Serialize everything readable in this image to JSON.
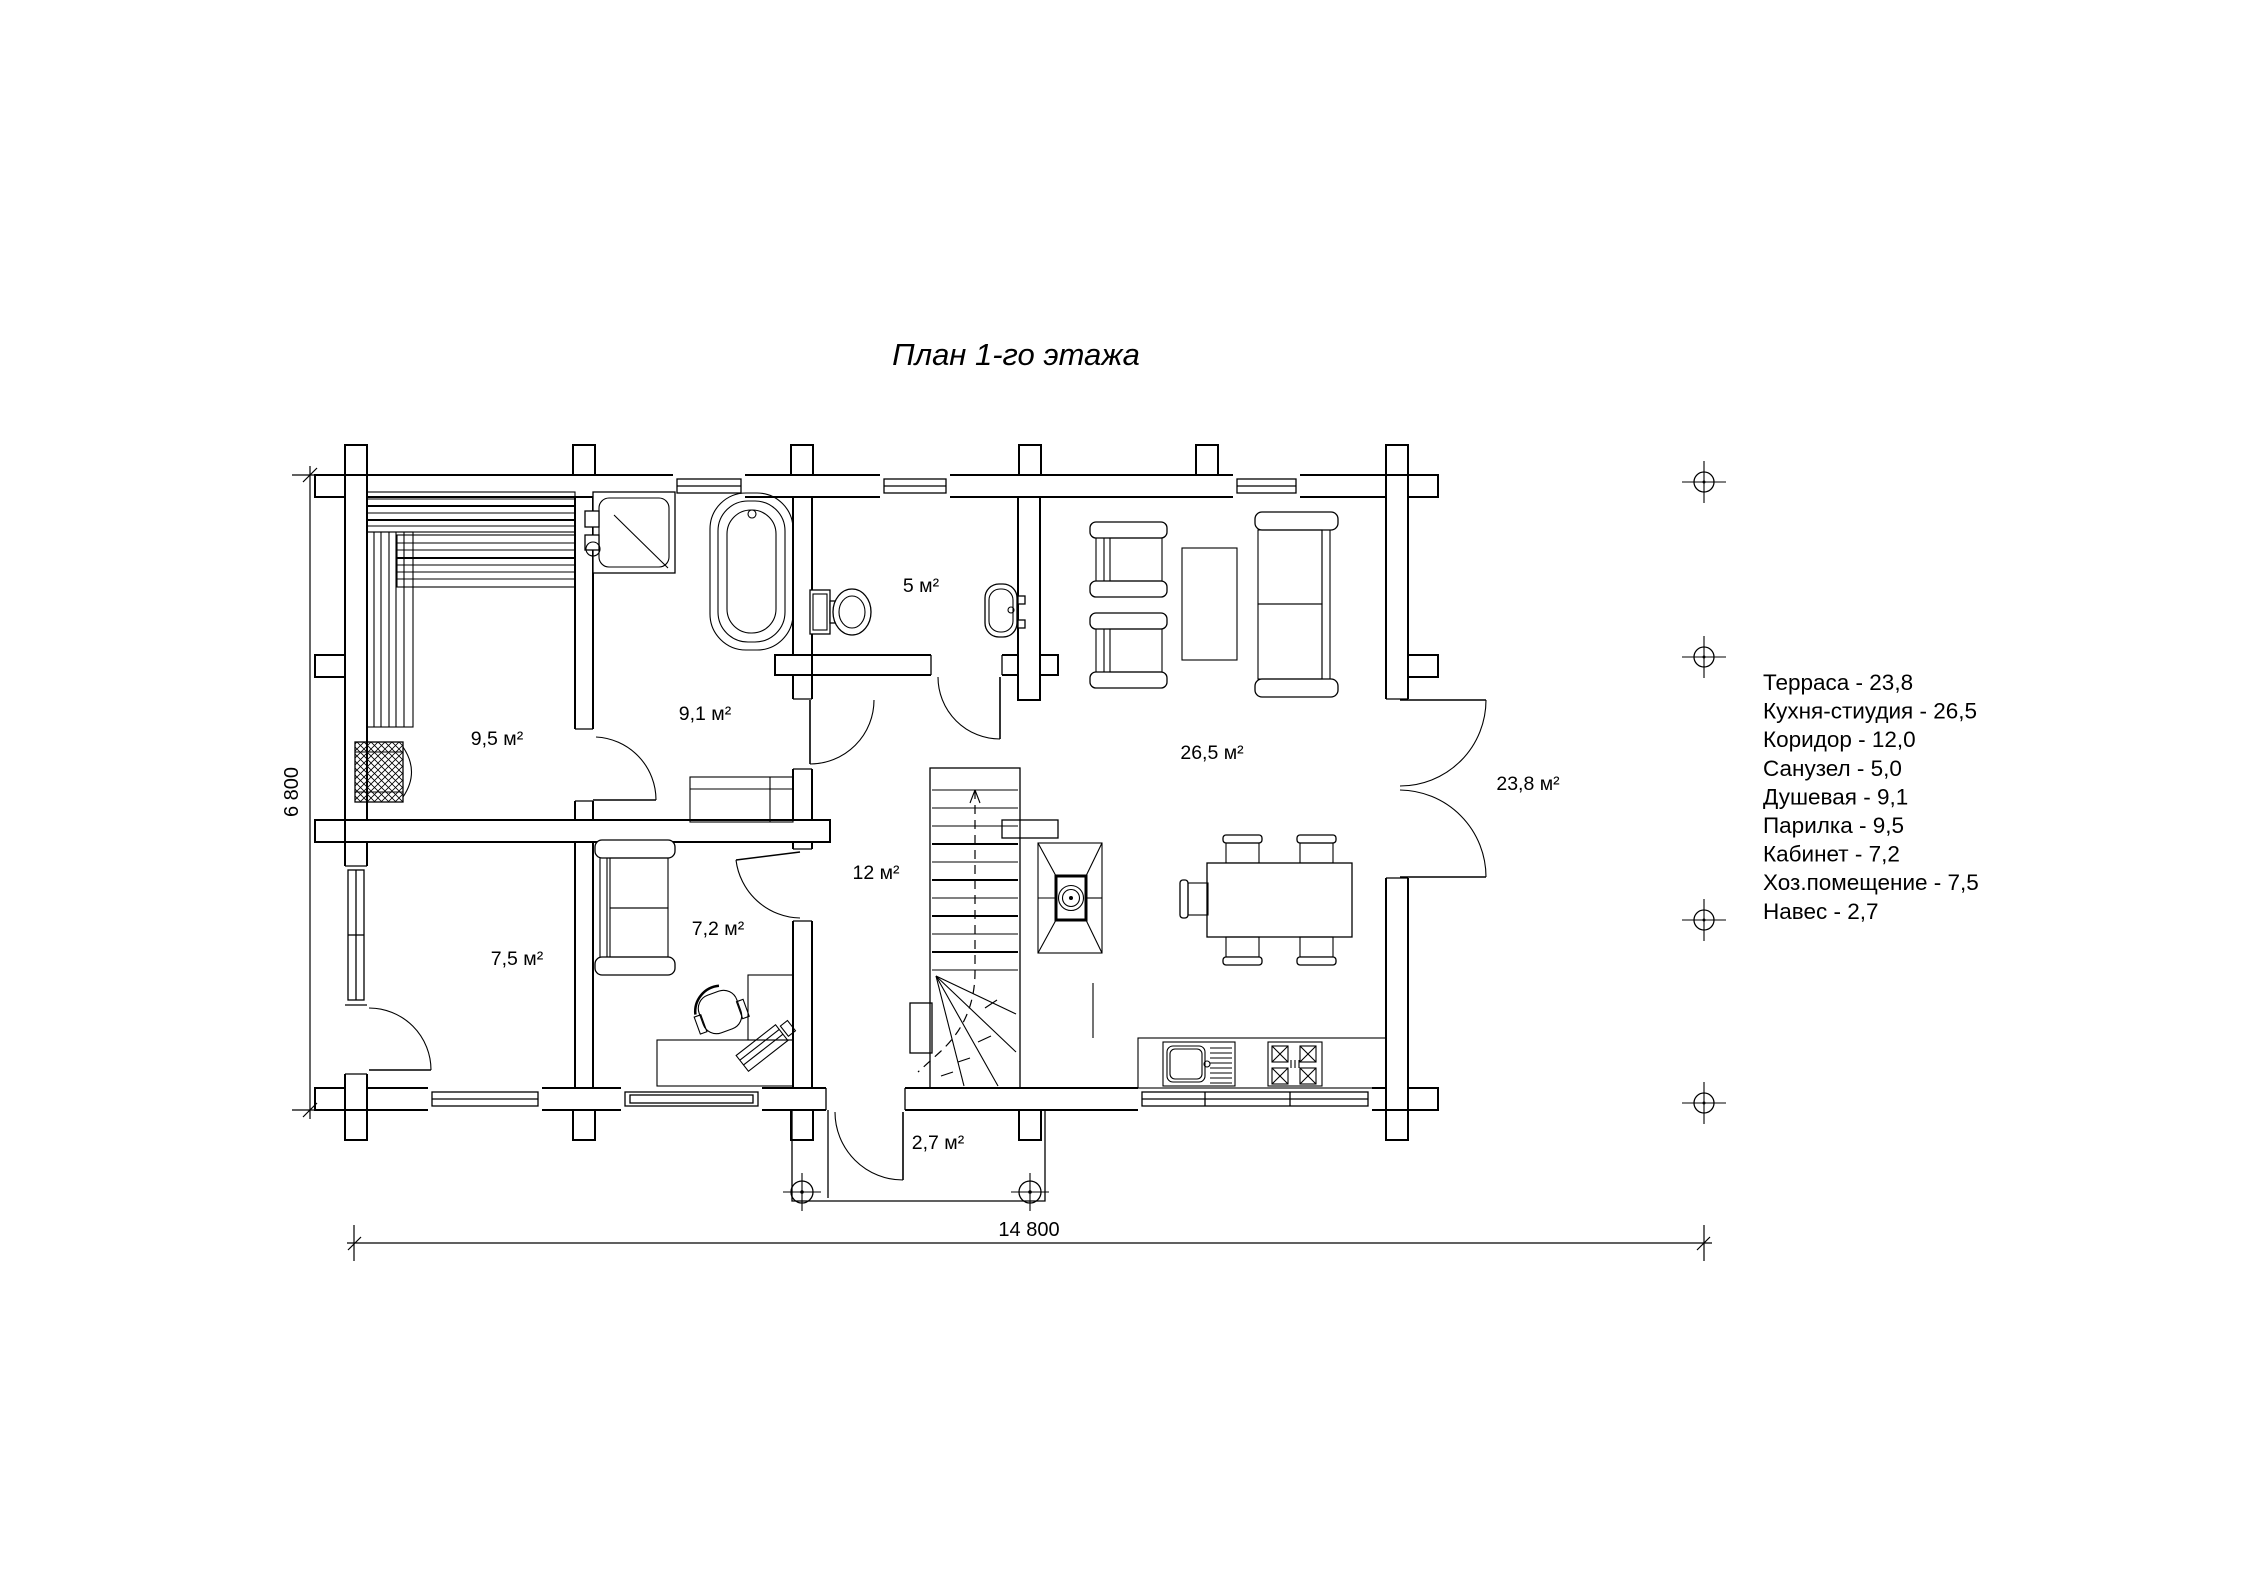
{
  "title": "План 1-го этажа",
  "legend": {
    "items": [
      "Терраса - 23,8",
      "Кухня-стиудия - 26,5",
      "Коридор - 12,0",
      "Санузел - 5,0",
      "Душевая - 9,1",
      "Парилка - 9,5",
      "Кабинет - 7,2",
      "Хоз.помещение - 7,5",
      "Навес - 2,7"
    ]
  },
  "room_labels": {
    "parilka": "9,5 м²",
    "dushevaya": "9,1 м²",
    "sanuzel": "5 м²",
    "kitchen_studio": "26,5 м²",
    "terrace": "23,8 м²",
    "koridor": "12 м²",
    "kabinet": "7,2 м²",
    "khoz_pomeshchenie": "7,5 м²",
    "naves": "2,7 м²"
  },
  "dimensions": {
    "horizontal": "14 800",
    "vertical": "6 800"
  },
  "colors": {
    "line": "#000000",
    "background": "#ffffff"
  }
}
